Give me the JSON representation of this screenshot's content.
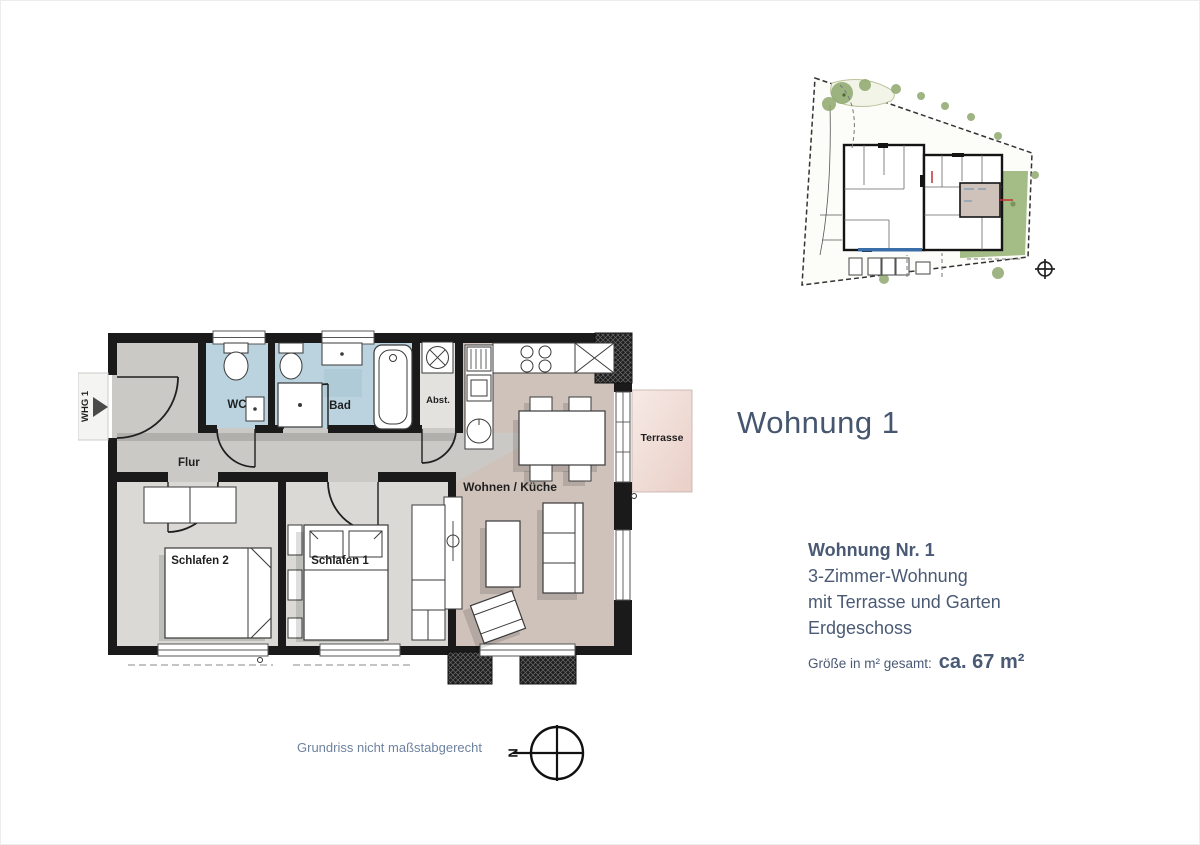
{
  "header": {
    "title": "Wohnung 1"
  },
  "info": {
    "lines": [
      "Wohnung Nr. 1",
      "3-Zimmer-Wohnung",
      "mit Terrasse und Garten",
      "Erdgeschoss"
    ],
    "size_label": "Größe in m² gesamt:",
    "size_value": "ca. 67 m²"
  },
  "floor_plan": {
    "entrance_label": "WHG 1",
    "rooms": {
      "wc": "WC",
      "bad": "Bad",
      "abst": "Abst.",
      "flur": "Flur",
      "schlafen2": "Schlafen 2",
      "schlafen1": "Schlafen 1",
      "wohnen": "Wohnen / Küche",
      "terrasse": "Terrasse"
    }
  },
  "footer": {
    "note": "Grundriss nicht maßstabgerecht",
    "compass_letter": "N"
  },
  "colors": {
    "accent": "#46566e",
    "wall": "#1a1a1a",
    "wet_room": "#bad3de",
    "hall": "#cbc9c6",
    "bedroom": "#dad9d6",
    "living": "#cfc2ba",
    "terrace": "#f0d8d1",
    "garden": "#9ab579"
  }
}
